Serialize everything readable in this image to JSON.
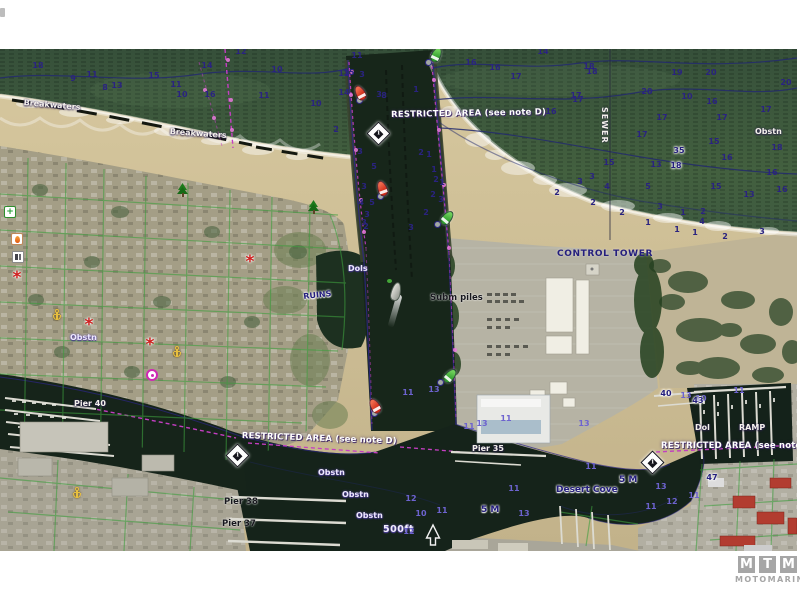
{
  "title": "Marine chartplotter satellite view",
  "colors": {
    "magenta_boundary": "#c43ec2",
    "contour_navy": "#242b6e",
    "depth_number_navy": "#2a2380",
    "depth_number_light": "#6d63cf",
    "buoy_red": "#cd2b18",
    "buoy_green": "#2f9c2c",
    "road_green": "#3f9e3f",
    "restricted_text": "#ffffff",
    "logo_gray": "#a6a6a6"
  },
  "watermark": {
    "letters": [
      "M",
      "T",
      "M"
    ],
    "name": "MOTOMARINE"
  },
  "map": {
    "info_glyph": "i",
    "labels": [
      {
        "id": "breakwaters-north-label",
        "text": "Breakwaters",
        "x": 24,
        "y": 99,
        "cls": "w",
        "rot": 5
      },
      {
        "id": "breakwaters-south-label",
        "text": "Breakwaters",
        "x": 170,
        "y": 128,
        "cls": "w",
        "rot": 4
      },
      {
        "id": "restricted-area-north-label",
        "text": "RESTRICTED AREA (see note D)",
        "x": 391,
        "y": 111,
        "cls": "r",
        "rot": -1
      },
      {
        "id": "sewer-label",
        "text": "SEWER",
        "x": 600,
        "y": 107,
        "cls": "v",
        "rot": 0
      },
      {
        "id": "obstn-offshore-label",
        "text": "Obstn",
        "x": 755,
        "y": 128,
        "cls": "w",
        "rot": 0
      },
      {
        "id": "control-tower-label",
        "text": "CONTROL TOWER",
        "x": 557,
        "y": 250,
        "cls": "ct",
        "rot": 0
      },
      {
        "id": "subm-piles-label",
        "text": "Subm piles",
        "x": 430,
        "y": 294,
        "cls": "bk",
        "rot": 0
      },
      {
        "id": "dols-label",
        "text": "Dols",
        "x": 348,
        "y": 265,
        "cls": "wp",
        "rot": 0
      },
      {
        "id": "ruins-label",
        "text": "RUINS",
        "x": 303,
        "y": 293,
        "cls": "n sm",
        "rot": -6
      },
      {
        "id": "obstn-town-label",
        "text": "Obstn",
        "x": 70,
        "y": 334,
        "cls": "wp",
        "rot": 0
      },
      {
        "id": "restricted-area-west-label",
        "text": "RESTRICTED AREA (see note D)",
        "x": 242,
        "y": 432,
        "cls": "r",
        "rot": 2
      },
      {
        "id": "obstn-harbor-1-label",
        "text": "Obstn",
        "x": 318,
        "y": 469,
        "cls": "wp",
        "rot": 0
      },
      {
        "id": "obstn-harbor-2-label",
        "text": "Obstn",
        "x": 342,
        "y": 491,
        "cls": "wp",
        "rot": 0
      },
      {
        "id": "obstn-harbor-3-label",
        "text": "Obstn",
        "x": 356,
        "y": 512,
        "cls": "wp",
        "rot": 0
      },
      {
        "id": "scale-label",
        "text": "500ft",
        "x": 383,
        "y": 525,
        "cls": "sc",
        "rot": 0
      },
      {
        "id": "pier-35-label",
        "text": "Pier 35",
        "x": 472,
        "y": 445,
        "cls": "w",
        "rot": 0
      },
      {
        "id": "restricted-area-east-label",
        "text": "RESTRICTED AREA (see note E)",
        "x": 661,
        "y": 442,
        "cls": "r",
        "rot": 0
      },
      {
        "id": "dol-label",
        "text": "Dol",
        "x": 695,
        "y": 424,
        "cls": "w",
        "rot": 0
      },
      {
        "id": "ramp-label",
        "text": "RAMP",
        "x": 739,
        "y": 424,
        "cls": "w",
        "rot": 0
      },
      {
        "id": "desert-cove-label",
        "text": "Desert Cove",
        "x": 556,
        "y": 486,
        "cls": "n",
        "rot": 0
      },
      {
        "id": "depth-area-east-label",
        "text": "5 M",
        "x": 619,
        "y": 476,
        "cls": "n",
        "rot": 0
      },
      {
        "id": "depth-area-south-label",
        "text": "5 M",
        "x": 481,
        "y": 506,
        "cls": "n",
        "rot": 0
      },
      {
        "id": "pier-38-label",
        "text": "Pier 38",
        "x": 224,
        "y": 498,
        "cls": "bk",
        "rot": 0
      },
      {
        "id": "pier-37-label",
        "text": "Pier 37",
        "x": 222,
        "y": 520,
        "cls": "bk",
        "rot": 0
      },
      {
        "id": "pier-40-label",
        "text": "Pier 40",
        "x": 74,
        "y": 400,
        "cls": "w",
        "rot": 0
      }
    ],
    "depths": [
      [
        38,
        66,
        "18"
      ],
      [
        73,
        79,
        "9"
      ],
      [
        92,
        75,
        "11"
      ],
      [
        105,
        88,
        "8"
      ],
      [
        117,
        86,
        "13"
      ],
      [
        154,
        76,
        "15"
      ],
      [
        176,
        85,
        "11"
      ],
      [
        182,
        95,
        "10"
      ],
      [
        207,
        66,
        "14"
      ],
      [
        210,
        95,
        "16"
      ],
      [
        241,
        52,
        "12"
      ],
      [
        277,
        70,
        "10"
      ],
      [
        264,
        96,
        "11"
      ],
      [
        316,
        104,
        "10"
      ],
      [
        344,
        74,
        "12"
      ],
      [
        357,
        56,
        "11"
      ],
      [
        384,
        96,
        "8"
      ],
      [
        362,
        75,
        "3"
      ],
      [
        471,
        63,
        "16"
      ],
      [
        495,
        68,
        "16"
      ],
      [
        516,
        77,
        "17"
      ],
      [
        543,
        52,
        "14"
      ],
      [
        576,
        96,
        "17"
      ],
      [
        589,
        67,
        "18"
      ],
      [
        551,
        112,
        "16"
      ],
      [
        592,
        72,
        "18"
      ],
      [
        647,
        92,
        "20"
      ],
      [
        677,
        73,
        "19"
      ],
      [
        711,
        73,
        "20"
      ],
      [
        786,
        83,
        "20"
      ],
      [
        578,
        100,
        "17"
      ],
      [
        687,
        97,
        "10"
      ],
      [
        712,
        102,
        "16"
      ],
      [
        766,
        110,
        "17"
      ],
      [
        662,
        118,
        "17"
      ],
      [
        722,
        118,
        "17"
      ],
      [
        714,
        142,
        "15"
      ],
      [
        727,
        158,
        "16"
      ],
      [
        777,
        148,
        "18"
      ],
      [
        642,
        135,
        "17"
      ],
      [
        609,
        163,
        "15"
      ],
      [
        656,
        165,
        "13"
      ],
      [
        772,
        173,
        "16"
      ],
      [
        716,
        187,
        "15"
      ],
      [
        749,
        195,
        "13"
      ],
      [
        782,
        190,
        "16"
      ],
      [
        679,
        151,
        "35",
        "h"
      ],
      [
        676,
        166,
        "18",
        "h"
      ],
      [
        592,
        177,
        "3"
      ],
      [
        607,
        187,
        "4"
      ],
      [
        593,
        203,
        "2"
      ],
      [
        622,
        213,
        "2"
      ],
      [
        648,
        187,
        "5"
      ],
      [
        683,
        213,
        "1"
      ],
      [
        703,
        212,
        "2"
      ],
      [
        660,
        207,
        "3"
      ],
      [
        442,
        183,
        "1"
      ],
      [
        433,
        195,
        "2"
      ],
      [
        557,
        193,
        "2"
      ],
      [
        580,
        182,
        "3"
      ],
      [
        648,
        223,
        "1"
      ],
      [
        677,
        230,
        "1"
      ],
      [
        695,
        233,
        "1"
      ],
      [
        725,
        237,
        "2"
      ],
      [
        762,
        232,
        "3"
      ],
      [
        702,
        222,
        "4"
      ],
      [
        349,
        73,
        "15"
      ],
      [
        344,
        93,
        "14"
      ],
      [
        379,
        95,
        "3"
      ],
      [
        416,
        90,
        "1"
      ],
      [
        336,
        130,
        "2"
      ],
      [
        360,
        152,
        "3"
      ],
      [
        374,
        167,
        "5"
      ],
      [
        364,
        187,
        "3"
      ],
      [
        361,
        203,
        "4"
      ],
      [
        372,
        203,
        "5"
      ],
      [
        364,
        223,
        "3"
      ],
      [
        429,
        155,
        "1"
      ],
      [
        421,
        153,
        "2"
      ],
      [
        434,
        170,
        "1"
      ],
      [
        436,
        180,
        "2"
      ],
      [
        441,
        200,
        "3"
      ],
      [
        426,
        213,
        "2"
      ],
      [
        411,
        228,
        "3"
      ],
      [
        366,
        227,
        "2"
      ],
      [
        367,
        215,
        "3"
      ],
      [
        408,
        393,
        "11",
        "l"
      ],
      [
        434,
        390,
        "13",
        "l"
      ],
      [
        469,
        427,
        "11",
        "l"
      ],
      [
        506,
        419,
        "11",
        "l"
      ],
      [
        482,
        424,
        "13",
        "l"
      ],
      [
        591,
        467,
        "11",
        "l"
      ],
      [
        661,
        487,
        "13",
        "l"
      ],
      [
        694,
        496,
        "11",
        "l"
      ],
      [
        672,
        502,
        "12",
        "l"
      ],
      [
        651,
        507,
        "11",
        "l"
      ],
      [
        524,
        514,
        "13",
        "l"
      ],
      [
        514,
        489,
        "11",
        "l"
      ],
      [
        411,
        499,
        "12",
        "l"
      ],
      [
        421,
        514,
        "10",
        "l"
      ],
      [
        442,
        511,
        "11",
        "l"
      ],
      [
        409,
        532,
        "12",
        "l"
      ],
      [
        584,
        424,
        "13",
        "l"
      ],
      [
        701,
        399,
        "10",
        "l"
      ],
      [
        686,
        396,
        "13",
        "l"
      ],
      [
        739,
        391,
        "11",
        "l"
      ],
      [
        666,
        394,
        "40",
        "h"
      ],
      [
        698,
        401,
        "43",
        "h"
      ],
      [
        712,
        478,
        "47",
        "h"
      ]
    ],
    "buoys": [
      [
        363,
        84,
        "red",
        -28
      ],
      [
        384,
        180,
        "red",
        -20
      ],
      [
        378,
        397,
        "red",
        -30
      ],
      [
        432,
        46,
        "green",
        25
      ],
      [
        441,
        208,
        "green",
        40
      ],
      [
        444,
        366,
        "green",
        40
      ]
    ],
    "info_markers": [
      [
        378,
        133
      ],
      [
        237,
        455
      ],
      [
        652,
        462
      ]
    ],
    "icons": [
      {
        "kind": "tree",
        "x": 177,
        "y": 183
      },
      {
        "kind": "tree",
        "x": 308,
        "y": 200
      },
      {
        "kind": "first-aid",
        "x": 4,
        "y": 206
      },
      {
        "kind": "flame",
        "x": 11,
        "y": 233
      },
      {
        "kind": "fuel",
        "x": 12,
        "y": 251
      },
      {
        "kind": "poi-red",
        "x": 10,
        "y": 271
      },
      {
        "kind": "poi-red",
        "x": 82,
        "y": 318
      },
      {
        "kind": "poi-red",
        "x": 143,
        "y": 338
      },
      {
        "kind": "poi-red",
        "x": 243,
        "y": 255
      },
      {
        "kind": "anchorage",
        "x": 52,
        "y": 309
      },
      {
        "kind": "anchorage",
        "x": 172,
        "y": 346
      },
      {
        "kind": "anchorage",
        "x": 72,
        "y": 487
      },
      {
        "kind": "marina",
        "x": 146,
        "y": 369
      }
    ],
    "vessel": {
      "x": 388,
      "y": 282,
      "rot": 14
    }
  }
}
